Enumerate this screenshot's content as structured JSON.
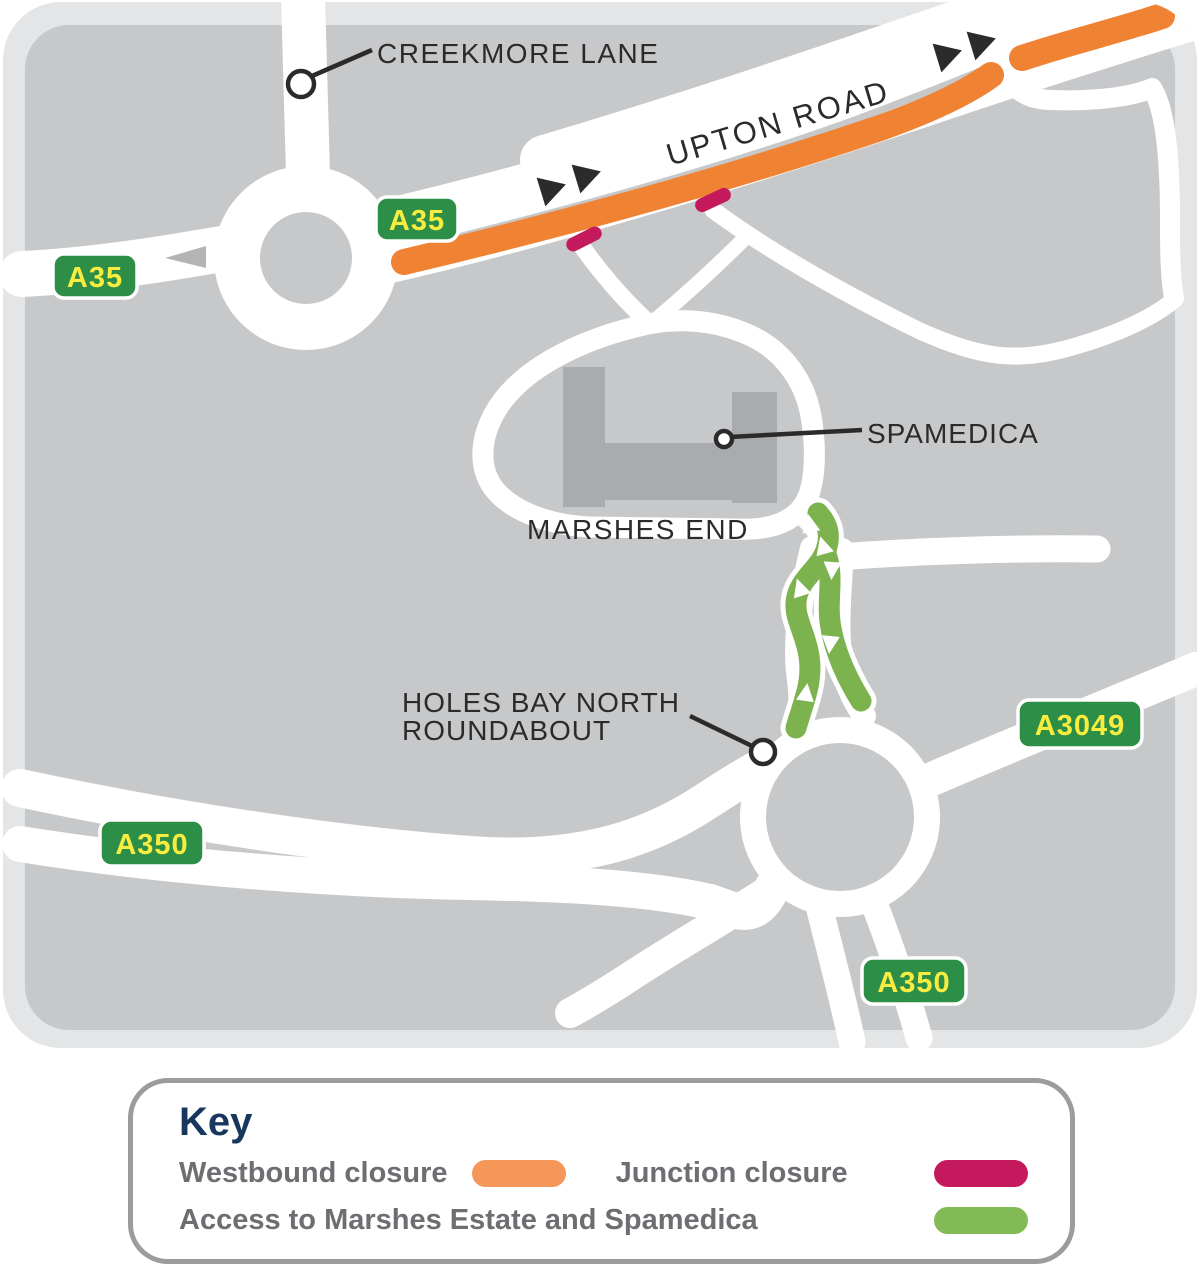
{
  "map": {
    "labels": {
      "creekmore_lane": "CREEKMORE LANE",
      "upton_road": "UPTON ROAD",
      "spamedica": "SPAMEDICA",
      "marshes_end": "MARSHES END",
      "holes_bay_roundabout_line1": "HOLES BAY NORTH",
      "holes_bay_roundabout_line2": "ROUNDABOUT"
    },
    "badges": {
      "a35_west": "A35",
      "a35_upton": "A35",
      "a3049": "A3049",
      "a350_west": "A350",
      "a350_south": "A350"
    },
    "colors": {
      "map_background": "#C7C8CA",
      "map_frame": "#E4E5E6",
      "road_white": "#FFFFFF",
      "building_grey": "#A9ABAE",
      "westbound_closure_orange": "#F08233",
      "junction_closure_pink": "#C5195D",
      "access_route_green": "#7CB34F",
      "badge_green": "#2D8F47",
      "badge_text_yellow": "#F8ED3F",
      "label_text": "#2B2B2B",
      "direction_arrow_black": "#2B2B2B"
    }
  },
  "key": {
    "title": "Key",
    "title_color": "#17375F",
    "items": [
      {
        "label": "Westbound closure",
        "color": "#F6975A"
      },
      {
        "label": "Junction closure",
        "color": "#C5195D"
      },
      {
        "label": "Access to Marshes Estate and Spamedica",
        "color": "#82BA55"
      }
    ]
  }
}
